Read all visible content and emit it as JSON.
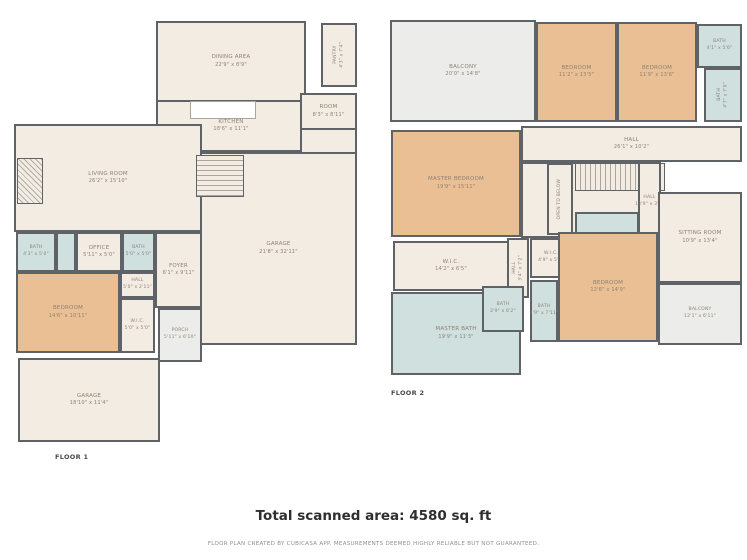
{
  "colors": {
    "wall": "#5f6367",
    "floor_fill": "#f3ece3",
    "bedroom_fill": "#eabf94",
    "bath_fill": "#cfe0df",
    "balcony_fill": "#ececea",
    "label_text": "#8d8274",
    "disclaimer_text": "#8f8f8f"
  },
  "floors": [
    {
      "label": "FLOOR 1",
      "rooms": [
        {
          "name": "DINING AREA",
          "dims": "22'9\" x 8'9\"",
          "type": "floor",
          "x": 156,
          "y": 21,
          "w": 150,
          "h": 81
        },
        {
          "name": "KITCHEN",
          "dims": "18'6\" x 11'1\"",
          "type": "floor",
          "x": 156,
          "y": 100,
          "w": 150,
          "h": 52
        },
        {
          "name": "PANTRY",
          "dims": "4'3\" x 7'4\"",
          "type": "floor",
          "vertical": true,
          "small": true,
          "x": 321,
          "y": 23,
          "w": 36,
          "h": 64
        },
        {
          "name": "ROOM",
          "dims": "8'3\" x 8'11\"",
          "type": "floor",
          "x": 300,
          "y": 93,
          "w": 57,
          "h": 37
        },
        {
          "type": "floor",
          "x": 300,
          "y": 128,
          "w": 57,
          "h": 26
        },
        {
          "name": "LIVING ROOM",
          "dims": "26'2\" x 15'10\"",
          "type": "floor",
          "x": 14,
          "y": 124,
          "w": 188,
          "h": 108
        },
        {
          "name": "GARAGE",
          "dims": "21'8\" x 32'11\"",
          "type": "floor",
          "x": 200,
          "y": 152,
          "w": 157,
          "h": 193
        },
        {
          "type": "stairs-v",
          "x": 196,
          "y": 155,
          "w": 48,
          "h": 42
        },
        {
          "type": "hatch",
          "x": 17,
          "y": 158,
          "w": 26,
          "h": 46
        },
        {
          "type": "island",
          "x": 190,
          "y": 101,
          "w": 66,
          "h": 18
        },
        {
          "name": "BATH",
          "dims": "4'3\" x 5'0\"",
          "type": "bath",
          "small": true,
          "x": 16,
          "y": 232,
          "w": 40,
          "h": 40
        },
        {
          "type": "bath",
          "x": 56,
          "y": 232,
          "w": 20,
          "h": 40
        },
        {
          "name": "OFFICE",
          "dims": "5'11\" x 5'0\"",
          "type": "floor",
          "x": 76,
          "y": 232,
          "w": 46,
          "h": 40
        },
        {
          "name": "BATH",
          "dims": "5'0\" x 5'0\"",
          "type": "bath",
          "small": true,
          "x": 122,
          "y": 232,
          "w": 33,
          "h": 40
        },
        {
          "name": "FOYER",
          "dims": "6'1\" x 9'11\"",
          "type": "floor",
          "x": 155,
          "y": 232,
          "w": 47,
          "h": 76
        },
        {
          "name": "HALL",
          "dims": "5'0\" x 2'11\"",
          "type": "floor",
          "small": true,
          "x": 120,
          "y": 272,
          "w": 35,
          "h": 26
        },
        {
          "name": "BEDROOM",
          "dims": "14'6\" x 10'11\"",
          "type": "bedroom",
          "x": 16,
          "y": 272,
          "w": 104,
          "h": 81
        },
        {
          "name": "W.I.C.",
          "dims": "5'0\" x 5'0\"",
          "type": "floor",
          "small": true,
          "x": 120,
          "y": 298,
          "w": 35,
          "h": 55
        },
        {
          "name": "PORCH",
          "dims": "5'11\" x 6'10\"",
          "type": "balcony",
          "small": true,
          "x": 158,
          "y": 308,
          "w": 44,
          "h": 54
        },
        {
          "name": "GARAGE",
          "dims": "18'10\" x 11'4\"",
          "type": "floor",
          "x": 18,
          "y": 358,
          "w": 142,
          "h": 84
        }
      ]
    },
    {
      "label": "FLOOR 2",
      "rooms": [
        {
          "name": "BALCONY",
          "dims": "20'0\" x 14'8\"",
          "type": "balcony",
          "x": 390,
          "y": 20,
          "w": 146,
          "h": 102
        },
        {
          "name": "BEDROOM",
          "dims": "11'2\" x 13'5\"",
          "type": "bedroom",
          "x": 536,
          "y": 22,
          "w": 81,
          "h": 100
        },
        {
          "name": "BEDROOM",
          "dims": "11'9\" x 13'6\"",
          "type": "bedroom",
          "x": 617,
          "y": 22,
          "w": 80,
          "h": 100
        },
        {
          "name": "BATH",
          "dims": "4'1\" x 5'6\"",
          "type": "bath",
          "small": true,
          "x": 697,
          "y": 24,
          "w": 45,
          "h": 44
        },
        {
          "name": "BATH",
          "dims": "4'7\" x 7'9\"",
          "type": "bath",
          "vertical": true,
          "small": true,
          "x": 704,
          "y": 68,
          "w": 38,
          "h": 54
        },
        {
          "name": "MASTER BEDROOM",
          "dims": "19'9\" x 15'11\"",
          "type": "bedroom",
          "x": 391,
          "y": 130,
          "w": 130,
          "h": 107
        },
        {
          "name": "HALL",
          "dims": "26'1\" x 10'2\"",
          "type": "floor",
          "x": 521,
          "y": 126,
          "w": 221,
          "h": 36
        },
        {
          "type": "floor",
          "x": 521,
          "y": 162,
          "w": 140,
          "h": 76
        },
        {
          "type": "stairs-h",
          "x": 575,
          "y": 163,
          "w": 90,
          "h": 28
        },
        {
          "name": "OPEN TO BELOW",
          "type": "floor",
          "vertical": true,
          "small": true,
          "x": 547,
          "y": 163,
          "w": 26,
          "h": 72
        },
        {
          "name": "HALL",
          "dims": "13'9\" x 3'3\"",
          "type": "floor",
          "small": true,
          "x": 638,
          "y": 162,
          "w": 23,
          "h": 79
        },
        {
          "name": "SITTING ROOM",
          "dims": "10'9\" x 13'4\"",
          "type": "floor",
          "x": 658,
          "y": 192,
          "w": 84,
          "h": 91
        },
        {
          "name": "LAUNDRY",
          "dims": "7'4\" x 7'9\"",
          "type": "bath",
          "x": 575,
          "y": 212,
          "w": 64,
          "h": 60
        },
        {
          "name": "W.I.C.",
          "dims": "14'2\" x 6'5\"",
          "type": "floor",
          "x": 393,
          "y": 241,
          "w": 116,
          "h": 50
        },
        {
          "name": "HALL",
          "dims": "3'4\" x 7'2\"",
          "type": "floor",
          "vertical": true,
          "small": true,
          "x": 507,
          "y": 238,
          "w": 22,
          "h": 60
        },
        {
          "name": "W.I.C.",
          "dims": "4'9\" x 5'1\"",
          "type": "floor",
          "small": true,
          "x": 530,
          "y": 238,
          "w": 42,
          "h": 40
        },
        {
          "name": "BEDROOM",
          "dims": "12'6\" x 14'9\"",
          "type": "bedroom",
          "x": 558,
          "y": 232,
          "w": 100,
          "h": 110
        },
        {
          "name": "MASTER BATH",
          "dims": "19'9\" x 11'3\"",
          "type": "bath",
          "x": 391,
          "y": 292,
          "w": 130,
          "h": 83
        },
        {
          "name": "BATH",
          "dims": "2'9\" x 6'2\"",
          "type": "bath",
          "small": true,
          "x": 482,
          "y": 286,
          "w": 42,
          "h": 46
        },
        {
          "name": "BATH",
          "dims": "3'9\" x 7'11\"",
          "type": "bath",
          "small": true,
          "x": 530,
          "y": 280,
          "w": 28,
          "h": 62
        },
        {
          "name": "BALCONY",
          "dims": "12'1\" x 6'11\"",
          "type": "balcony",
          "small": true,
          "x": 658,
          "y": 283,
          "w": 84,
          "h": 62
        }
      ]
    }
  ],
  "footer": {
    "total": "Total scanned area: 4580 sq. ft",
    "disclaimer": "FLOOR PLAN CREATED BY CUBICASA APP. MEASUREMENTS DEEMED HIGHLY RELIABLE BUT NOT GUARANTEED."
  }
}
